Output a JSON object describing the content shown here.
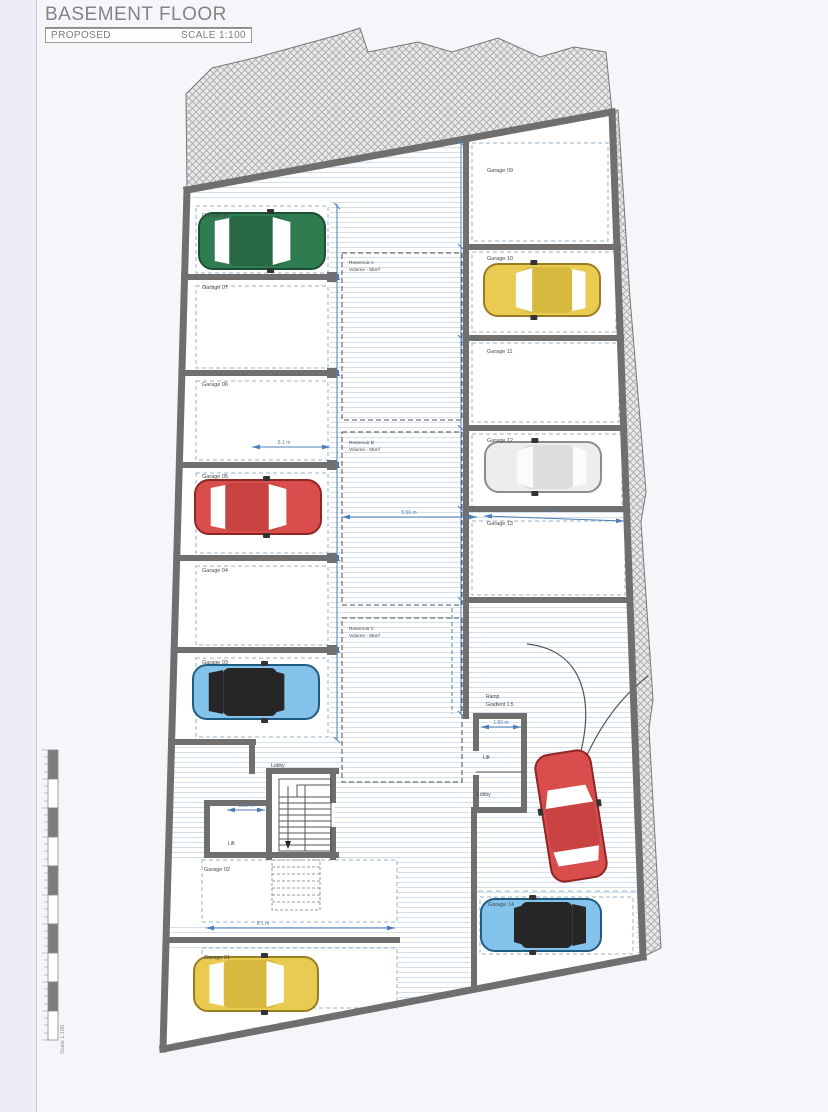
{
  "title_block": {
    "title": "BASEMENT FLOOR",
    "status": "PROPOSED",
    "scale": "SCALE 1:100"
  },
  "plan": {
    "garage_labels": [
      "Garage 01",
      "Garage 02",
      "Garage 03",
      "Garage 04",
      "Garage 05",
      "Garage 06",
      "Garage 07",
      "Garage 08",
      "Garage 09",
      "Garage 10",
      "Garage 11",
      "Garage 12",
      "Garage 13",
      "Garage 14"
    ],
    "reservoirs": [
      {
        "name": "Reservoir A",
        "volume": "Volume - 55m³"
      },
      {
        "name": "Reservoir B",
        "volume": "Volume - 55m³"
      },
      {
        "name": "Reservoir C",
        "volume": "Volume - 55m³"
      }
    ],
    "rooms": {
      "lobby_left": "Lobby",
      "lift_left": "Lift",
      "lift_right": "Lift",
      "lobby_right": "Lobby"
    },
    "ramp": {
      "name": "Ramp",
      "gradient": "Gradient 1:5"
    },
    "dims": {
      "bay_width": "5.1 m",
      "corridor_width": "5.56 m",
      "garage13_width": "3.7 m",
      "garage02_width": "6.1 m",
      "lift_left_width": "1.55 m",
      "lift_right_width": "1.50 m"
    },
    "scale_bar": {
      "label": "Scale 1:100"
    },
    "colors": {
      "wall": "#6f6f6f",
      "dimension": "#4b7eb8",
      "floor_line": "#d3e0ec",
      "hatch_line": "#a8a8a8",
      "hatch_bg": "#e9e9e9",
      "bay_dash": "#9ab0c4",
      "label_text": "#4a4a4a"
    },
    "cars": [
      {
        "name": "car-garage-08",
        "x": 262,
        "y": 241,
        "rot": 0,
        "len": 126,
        "wid": 56,
        "body": "#2f7c50",
        "roof": "#276843",
        "glass": "#ffffff",
        "stroke": "#1b4f33"
      },
      {
        "name": "car-garage-05",
        "x": 258,
        "y": 507,
        "rot": 0,
        "len": 126,
        "wid": 54,
        "body": "#da4d4d",
        "roof": "#c94343",
        "glass": "#ffffff",
        "stroke": "#8f2626"
      },
      {
        "name": "car-garage-03",
        "x": 256,
        "y": 692,
        "rot": 0,
        "len": 126,
        "wid": 54,
        "body": "#84c3ec",
        "roof": "#262626",
        "glass": "#262626",
        "stroke": "#1f5c80"
      },
      {
        "name": "car-garage-01",
        "x": 256,
        "y": 984,
        "rot": 0,
        "len": 124,
        "wid": 54,
        "body": "#e9cb52",
        "roof": "#d8b93f",
        "glass": "#ffffff",
        "stroke": "#9a7d22"
      },
      {
        "name": "car-garage-10",
        "x": 542,
        "y": 290,
        "rot": 180,
        "len": 116,
        "wid": 52,
        "body": "#e9cb52",
        "roof": "#d8b93f",
        "glass": "#ffffff",
        "stroke": "#9a7d22"
      },
      {
        "name": "car-garage-12",
        "x": 543,
        "y": 467,
        "rot": 180,
        "len": 116,
        "wid": 50,
        "body": "#ededed",
        "roof": "#dddddd",
        "glass": "#fbfbfb",
        "stroke": "#8c8c8c"
      },
      {
        "name": "car-garage-14",
        "x": 541,
        "y": 925,
        "rot": 180,
        "len": 120,
        "wid": 52,
        "body": "#84c3ec",
        "roof": "#262626",
        "glass": "#262626",
        "stroke": "#1f5c80"
      },
      {
        "name": "car-ramp",
        "x": 571,
        "y": 816,
        "rot": -99,
        "len": 128,
        "wid": 56,
        "body": "#da4d4d",
        "roof": "#c94343",
        "glass": "#ffffff",
        "stroke": "#8f2626"
      }
    ]
  }
}
